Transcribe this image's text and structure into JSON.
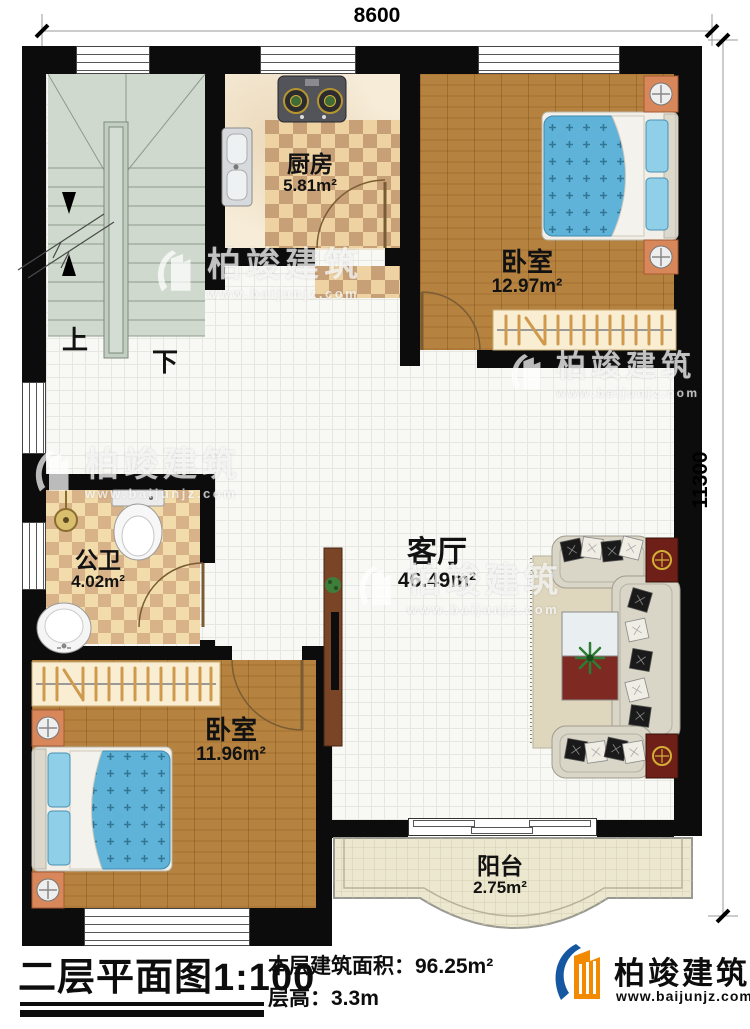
{
  "dimensions": {
    "width": "8600",
    "height": "11300"
  },
  "stairs": {
    "up": "上",
    "down": "下"
  },
  "rooms": [
    {
      "name": "厨房",
      "area": "5.81m²"
    },
    {
      "name": "卧室",
      "area": "12.97m²"
    },
    {
      "name": "客厅",
      "area": "46.49m²"
    },
    {
      "name": "公卫",
      "area": "4.02m²"
    },
    {
      "name": "卧室",
      "area": "11.96m²"
    },
    {
      "name": "阳台",
      "area": "2.75m²"
    }
  ],
  "footer": {
    "title": "二层平面图",
    "scale": "1:100",
    "area_label": "本层建筑面积：",
    "area_value": "96.25m²",
    "height_label": "层高：",
    "height_value": "3.3m"
  },
  "brand": {
    "name": "柏竣建筑",
    "website": "www.baijunjz.com"
  },
  "colors": {
    "wall": "#0c0c0c",
    "wood": "#b5823f",
    "mattress": "#5fb3d8",
    "accent_blue": "#1557a0",
    "accent_orange": "#f18a00"
  }
}
